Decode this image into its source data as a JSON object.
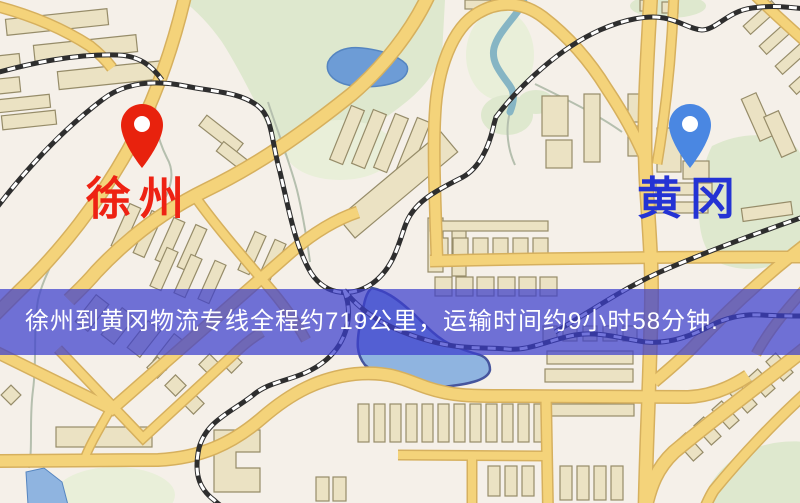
{
  "banner": {
    "text": "徐州到黄冈物流专线全程约719公里，运输时间约9小时58分钟.",
    "background": "rgba(60,62,205,0.72)",
    "text_color": "#ffffff"
  },
  "route": {
    "origin": "徐州",
    "destination": "黄冈",
    "distance_km": "719",
    "duration": "9小时58分钟"
  },
  "markers": [
    {
      "role": "origin",
      "label": "徐州",
      "label_color": "#ee2213",
      "pin_color": "#e8220d",
      "icon": "location-pin-icon"
    },
    {
      "role": "destination",
      "label": "黄冈",
      "label_color": "#2433d4",
      "pin_color": "#4a87e2",
      "icon": "location-pin-icon"
    }
  ],
  "map": {
    "palette": {
      "background": "#f5f0e9",
      "park": "#dee8ce",
      "park_light": "#e9efd9",
      "water": "#6d9cd6",
      "water_light": "#8fb4e0",
      "water_edge": "#46559e",
      "road": "#f4d37a",
      "road_casing": "#d6b05e",
      "railway": "#2e2e2e",
      "railway_dash": "#ffffff",
      "building": "#ebe2c3",
      "building_outline": "#968c69",
      "stream": "#b5bfae",
      "river_teal": "#86b5c4"
    }
  }
}
